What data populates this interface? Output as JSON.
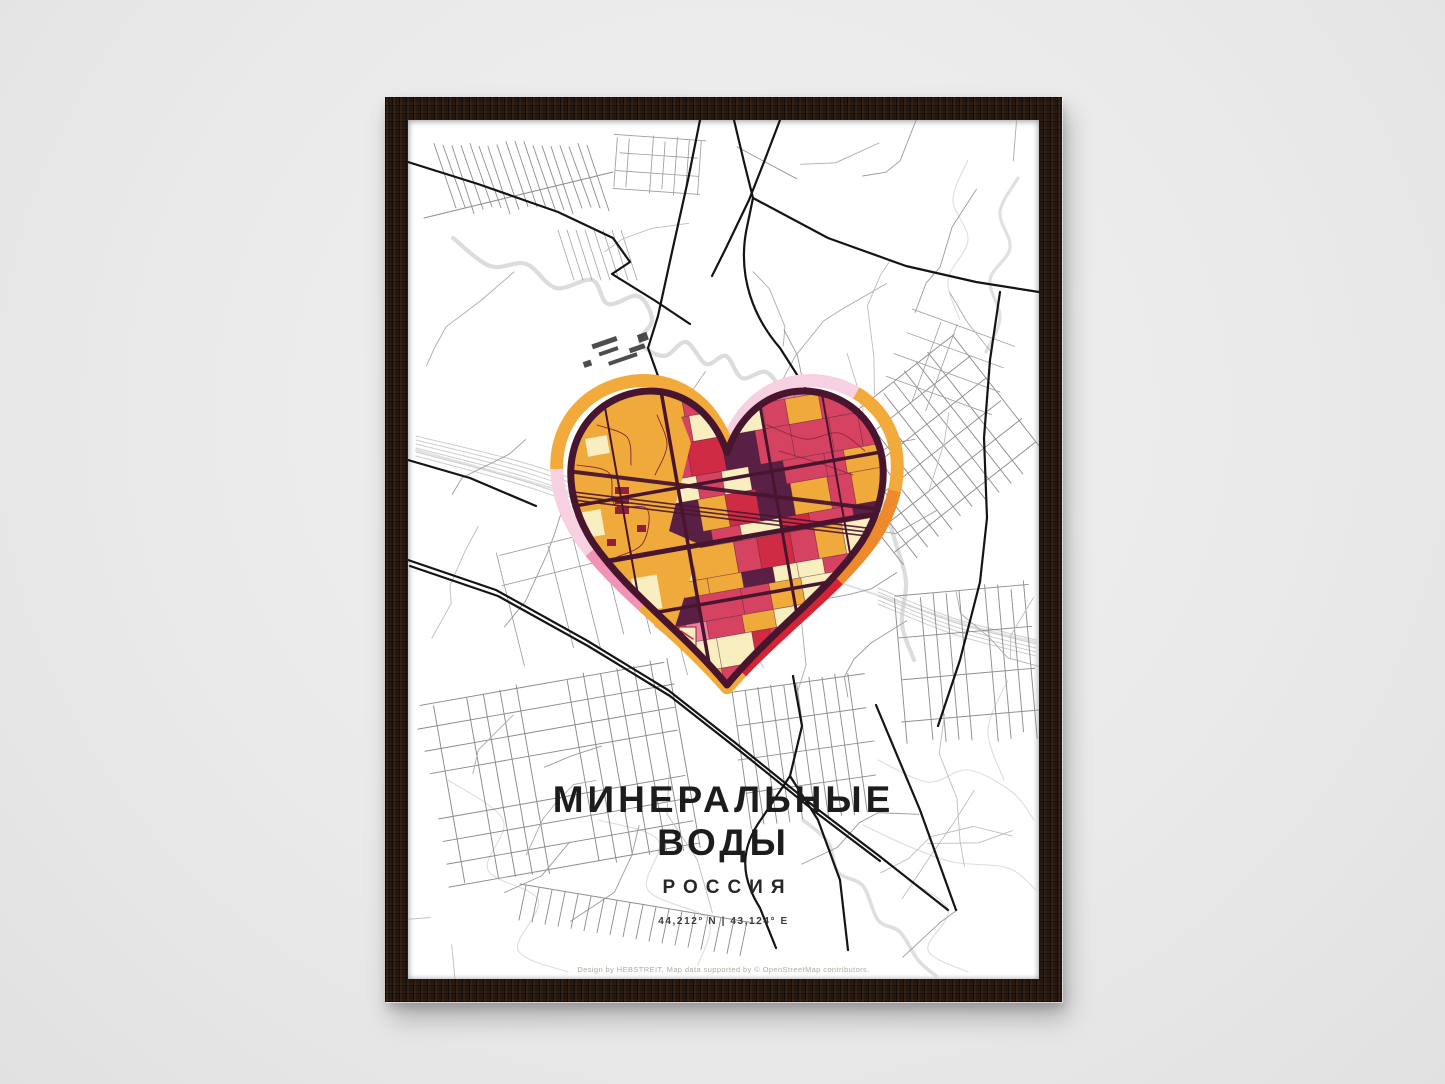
{
  "poster": {
    "title": "МИНЕРАЛЬНЫЕ ВОДЫ",
    "subtitle": "РОССИЯ",
    "coordinates": "44,212° N | 43,124° E",
    "credit": "Design by HEBSTREIT, Map data supported by © OpenStreetMap contributors."
  },
  "heart": {
    "outline_color": "#48152e",
    "street_color": "#7c1f38",
    "palette": {
      "amber": "#f0a93b",
      "crimson": "#d64362",
      "red": "#cf2b44",
      "cream": "#f8eec0",
      "plum": "#5a1f44",
      "pink": "#ef7fa0"
    },
    "ring_segments": [
      {
        "name": "top-right-lobe",
        "color": "#f7d0e1",
        "fraction": 0.15
      },
      {
        "name": "right-upper",
        "color": "#f2ab3a",
        "fraction": 0.105
      },
      {
        "name": "right-lower",
        "color": "#ef8a2c",
        "fraction": 0.1
      },
      {
        "name": "bottom-right",
        "color": "#d42332",
        "fraction": 0.125
      },
      {
        "name": "bottom-left",
        "color": "#f2ab3a",
        "fraction": 0.13
      },
      {
        "name": "left-lower",
        "color": "#f292b5",
        "fraction": 0.07
      },
      {
        "name": "left-mid",
        "color": "#f7d0e1",
        "fraction": 0.085
      },
      {
        "name": "top-left-lobe",
        "color": "#f2ab3a",
        "fraction": 0.235
      }
    ]
  },
  "map_colors": {
    "street_light": "#c7c7c7",
    "street_mid": "#8f8f8f",
    "road_major": "#141414",
    "water": "#dadada",
    "rail": "#c9c9c9",
    "contour": "#d9d9d9",
    "building": "#2e2e2e"
  },
  "frame": {
    "wood": "#231710",
    "wall": "#eaeaea",
    "paper": "#ffffff"
  }
}
